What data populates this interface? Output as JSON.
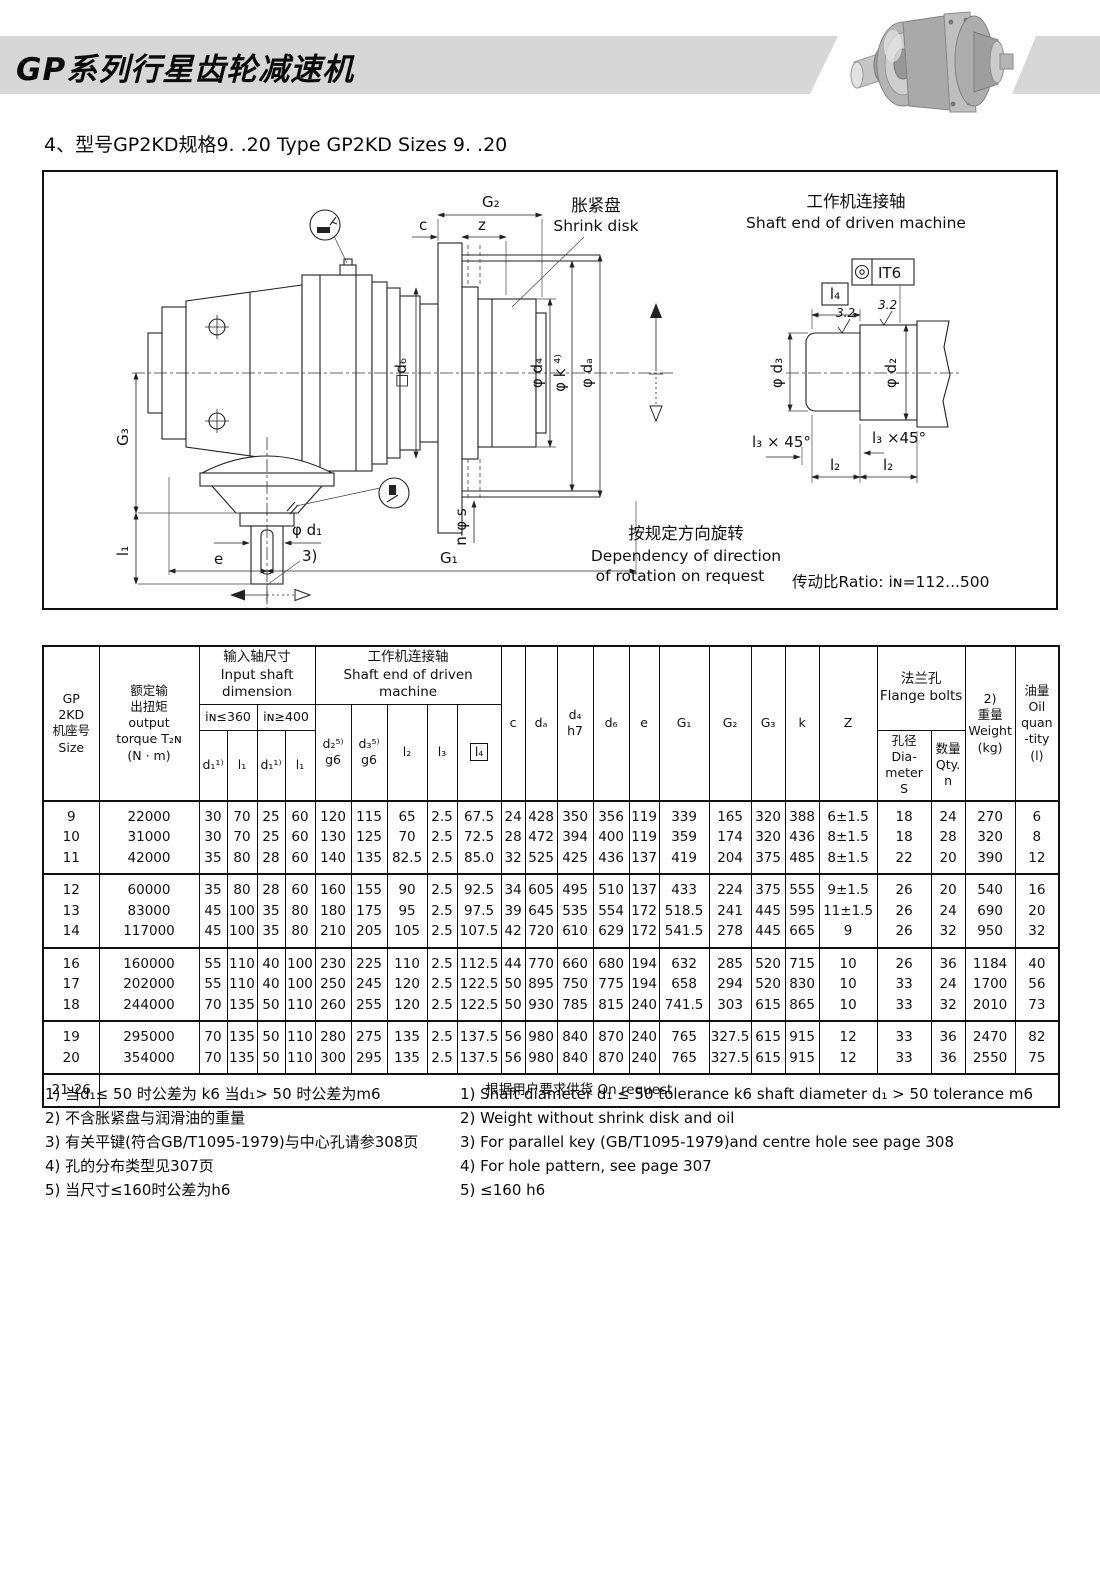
{
  "page": {
    "title": "GP系列行星齿轮减速机",
    "subtitle": "4、型号GP2KD规格9. .20  Type GP2KD Sizes 9. .20"
  },
  "drawing": {
    "shrink_disk_cn": "胀紧盘",
    "shrink_disk_en": "Shrink disk",
    "shaft_end_cn": "工作机连接轴",
    "shaft_end_en": "Shaft end of driven machine",
    "rotation_cn": "按规定方向旋转",
    "rotation_en_1": "Dependency of direction",
    "rotation_en_2": "of rotation on request",
    "ratio": "传动比Ratio: iɴ=112...500",
    "dims": {
      "g2": "G₂",
      "c": "c",
      "z": "z",
      "g3": "G₃",
      "l1": "l₁",
      "e": "e",
      "g1": "G₁",
      "d1": "φ d₁",
      "note3": "3)",
      "d6": "□d₆",
      "d4": "φ d₄",
      "k": "φ k  ⁴⁾",
      "da": "φ dₐ",
      "ns": "n-φ s",
      "it6": "IT6",
      "l4_box": "l₄",
      "d3": "φ d₃",
      "d2": "φ d₂",
      "l3a": "l₃ × 45°",
      "l3b": "l₃ ×45°",
      "l2a": "l₂",
      "l2b": "l₂",
      "r32a": "3.2",
      "r32b": "3.2"
    }
  },
  "table": {
    "h": {
      "size": "GP\n2KD\n机座号\nSize",
      "torque": "额定输\n出扭矩\noutput\ntorque T₂ɴ\n(N · m)",
      "input_group": "输入轴尺寸\nInput shaft\ndimension",
      "shaft_group": "工作机连接轴\nShaft end of driven machine",
      "in360": "iɴ≤360",
      "in400": "iɴ≥400",
      "d1a": "d₁¹⁾",
      "l1a": "l₁",
      "d1b": "d₁¹⁾",
      "l1b": "l₁",
      "d2": "d₂⁵⁾\ng6",
      "d3": "d₃⁵⁾\ng6",
      "l2": "l₂",
      "l3": "l₃",
      "l4": "l₄",
      "c": "c",
      "da": "dₐ",
      "d4": "d₄\nh7",
      "d6": "d₆",
      "e": "e",
      "g1": "G₁",
      "g2": "G₂",
      "g3": "G₃",
      "k": "k",
      "z": "Z",
      "flange_group": "法兰孔\nFlange bolts",
      "s": "孔径\nDia-meter\nS",
      "n": "数量\nQty.\nn",
      "weight": "2)\n重量\nWeight\n(kg)",
      "oil": "油量\nOil\nquan\n-tity\n(l)"
    },
    "groups": [
      {
        "rows": [
          [
            "9",
            "22000",
            "30",
            "70",
            "25",
            "60",
            "120",
            "115",
            "65",
            "2.5",
            "67.5",
            "24",
            "428",
            "350",
            "356",
            "119",
            "339",
            "165",
            "320",
            "388",
            "6±1.5",
            "18",
            "24",
            "270",
            "6"
          ],
          [
            "10",
            "31000",
            "30",
            "70",
            "25",
            "60",
            "130",
            "125",
            "70",
            "2.5",
            "72.5",
            "28",
            "472",
            "394",
            "400",
            "119",
            "359",
            "174",
            "320",
            "436",
            "8±1.5",
            "18",
            "28",
            "320",
            "8"
          ],
          [
            "11",
            "42000",
            "35",
            "80",
            "28",
            "60",
            "140",
            "135",
            "82.5",
            "2.5",
            "85.0",
            "32",
            "525",
            "425",
            "436",
            "137",
            "419",
            "204",
            "375",
            "485",
            "8±1.5",
            "22",
            "20",
            "390",
            "12"
          ]
        ]
      },
      {
        "rows": [
          [
            "12",
            "60000",
            "35",
            "80",
            "28",
            "60",
            "160",
            "155",
            "90",
            "2.5",
            "92.5",
            "34",
            "605",
            "495",
            "510",
            "137",
            "433",
            "224",
            "375",
            "555",
            "9±1.5",
            "26",
            "20",
            "540",
            "16"
          ],
          [
            "13",
            "83000",
            "45",
            "100",
            "35",
            "80",
            "180",
            "175",
            "95",
            "2.5",
            "97.5",
            "39",
            "645",
            "535",
            "554",
            "172",
            "518.5",
            "241",
            "445",
            "595",
            "11±1.5",
            "26",
            "24",
            "690",
            "20"
          ],
          [
            "14",
            "117000",
            "45",
            "100",
            "35",
            "80",
            "210",
            "205",
            "105",
            "2.5",
            "107.5",
            "42",
            "720",
            "610",
            "629",
            "172",
            "541.5",
            "278",
            "445",
            "665",
            "9",
            "26",
            "32",
            "950",
            "32"
          ]
        ]
      },
      {
        "rows": [
          [
            "16",
            "160000",
            "55",
            "110",
            "40",
            "100",
            "230",
            "225",
            "110",
            "2.5",
            "112.5",
            "44",
            "770",
            "660",
            "680",
            "194",
            "632",
            "285",
            "520",
            "715",
            "10",
            "26",
            "36",
            "1184",
            "40"
          ],
          [
            "17",
            "202000",
            "55",
            "110",
            "40",
            "100",
            "250",
            "245",
            "120",
            "2.5",
            "122.5",
            "50",
            "895",
            "750",
            "775",
            "194",
            "658",
            "294",
            "520",
            "830",
            "10",
            "33",
            "24",
            "1700",
            "56"
          ],
          [
            "18",
            "244000",
            "70",
            "135",
            "50",
            "110",
            "260",
            "255",
            "120",
            "2.5",
            "122.5",
            "50",
            "930",
            "785",
            "815",
            "240",
            "741.5",
            "303",
            "615",
            "865",
            "10",
            "33",
            "32",
            "2010",
            "73"
          ]
        ]
      },
      {
        "rows": [
          [
            "19",
            "295000",
            "70",
            "135",
            "50",
            "110",
            "280",
            "275",
            "135",
            "2.5",
            "137.5",
            "56",
            "980",
            "840",
            "870",
            "240",
            "765",
            "327.5",
            "615",
            "915",
            "12",
            "33",
            "36",
            "2470",
            "82"
          ],
          [
            "20",
            "354000",
            "70",
            "135",
            "50",
            "110",
            "300",
            "295",
            "135",
            "2.5",
            "137.5",
            "56",
            "980",
            "840",
            "870",
            "240",
            "765",
            "327.5",
            "615",
            "915",
            "12",
            "33",
            "36",
            "2550",
            "75"
          ]
        ]
      }
    ],
    "footer": {
      "size": "21-26",
      "note": "根据用户要求供货   On request"
    }
  },
  "footnotes": {
    "cn": [
      "1) 当d₁≤ 50 时公差为 k6 当d₁> 50 时公差为m6",
      "2) 不含胀紧盘与润滑油的重量",
      "3) 有关平键(符合GB/T1095-1979)与中心孔请参308页",
      "4) 孔的分布类型见307页",
      "5) 当尺寸≤160时公差为h6"
    ],
    "en": [
      "1) Shaft diameter d₁ ≤ 50  tolerance k6   shaft diameter d₁ > 50  tolerance m6",
      "2) Weight without shrink disk and oil",
      "3) For parallel key (GB/T1095-1979)and centre hole see page 308",
      "4) For hole pattern, see page 307",
      "5) ≤160 h6"
    ]
  }
}
